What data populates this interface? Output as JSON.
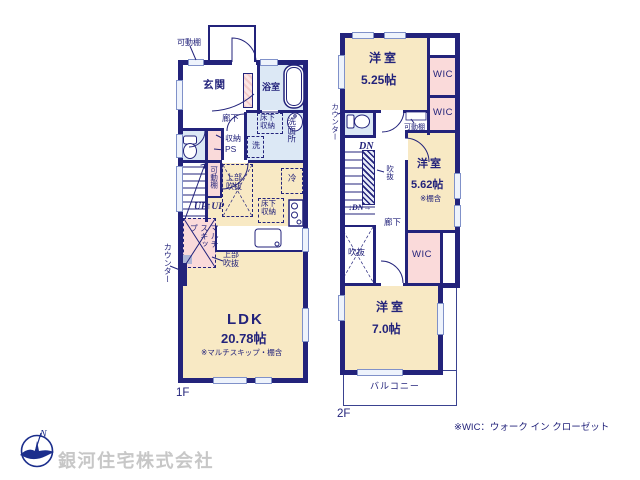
{
  "colors": {
    "wall": "#23237b",
    "room": "#f8e9c4",
    "wet": "#dce8f5",
    "closet": "#fadada",
    "window_fill": "#eef3fc",
    "window_edge": "#8091c9",
    "text": "#23237b",
    "thin": "#3a4290",
    "company": "#c7c7c7",
    "logo": "#1b2e8c"
  },
  "floor1": {
    "name": "1F",
    "rooms": {
      "kadoudana_top": "可動棚",
      "genkan": "玄関",
      "bath": "浴室",
      "hall": "廊下",
      "underfloor_wash": "床下収納",
      "washroom": "洗面所",
      "washer": "洗",
      "storage": "収納",
      "ps": "PS",
      "kadoudana_strip": "可動棚",
      "upper_void_1": "上部吹抜",
      "stairs_up": "UP↑UP",
      "multi_skip": "マルチスキップ",
      "counter": "カウンター",
      "upper_void_2": "上部吹抜",
      "fridge": "冷",
      "underfloor_kitchen": "床下収納",
      "ldk": "LDK",
      "ldk_size": "20.78帖",
      "ldk_note": "※マルチスキップ・棚含"
    }
  },
  "floor2": {
    "name": "2F",
    "rooms": {
      "bedroom1": "洋室",
      "bedroom1_size": "5.25帖",
      "wic1": "WIC",
      "wic2": "WIC",
      "kadoudana": "可動棚",
      "counter": "カウンター",
      "stairs_dn": "DN",
      "stairs_dn2": "↓DN→",
      "void_stair": "吹抜",
      "hall": "廊下",
      "bedroom2": "洋室",
      "bedroom2_size": "5.62帖",
      "bedroom2_note": "※棚含",
      "wic3": "WIC",
      "void": "吹抜",
      "bedroom3": "洋室",
      "bedroom3_size": "7.0帖",
      "balcony": "バルコニー"
    }
  },
  "legend": {
    "wic_note": "※WIC：ウォーク イン クローゼット"
  },
  "company": {
    "name": "銀河住宅株式会社",
    "logo_letter": "N"
  }
}
